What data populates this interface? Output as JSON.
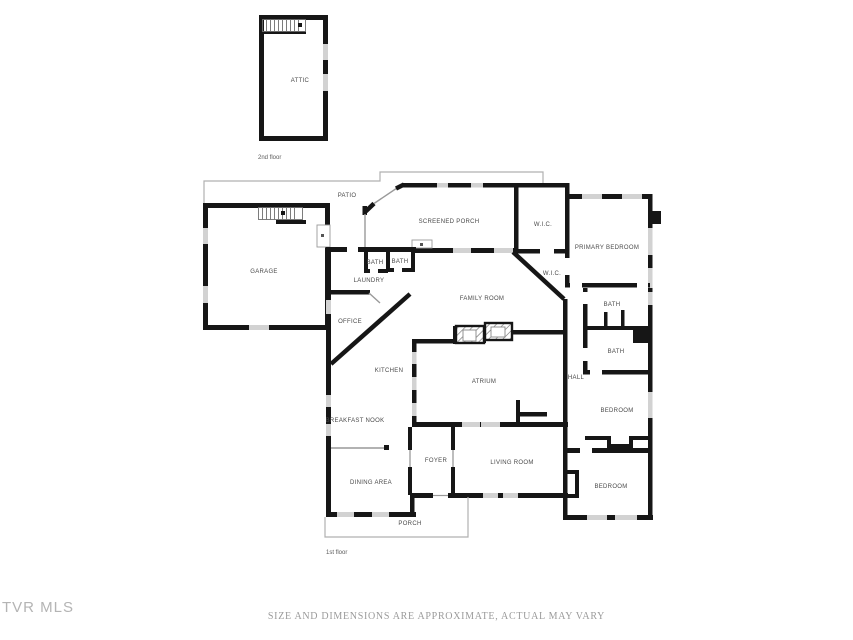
{
  "page": {
    "watermark": "TVR MLS",
    "footer_disclaimer": "SIZE AND DIMENSIONS ARE APPROXIMATE, ACTUAL MAY VARY"
  },
  "floorplan": {
    "floor2_label": "2nd floor",
    "floor1_label": "1st floor",
    "colors": {
      "wall": "#161616",
      "window": "#d2d2d2",
      "outline": "#b0b0b0",
      "label": "#4a4a4a"
    },
    "rooms": [
      {
        "label": "ATTIC",
        "x": 300,
        "y": 81
      },
      {
        "label": "PATIO",
        "x": 347,
        "y": 196
      },
      {
        "label": "SCREENED PORCH",
        "x": 449,
        "y": 222
      },
      {
        "label": "W.I.C.",
        "x": 543,
        "y": 225
      },
      {
        "label": "PRIMARY BEDROOM",
        "x": 607,
        "y": 248
      },
      {
        "label": "BATH",
        "x": 375,
        "y": 263
      },
      {
        "label": "BATH",
        "x": 400,
        "y": 262
      },
      {
        "label": "W.I.C.",
        "x": 552,
        "y": 274
      },
      {
        "label": "LAUNDRY",
        "x": 369,
        "y": 281
      },
      {
        "label": "GARAGE",
        "x": 264,
        "y": 272
      },
      {
        "label": "FAMILY ROOM",
        "x": 482,
        "y": 299
      },
      {
        "label": "BATH",
        "x": 612,
        "y": 305
      },
      {
        "label": "OFFICE",
        "x": 350,
        "y": 322
      },
      {
        "label": "BATH",
        "x": 616,
        "y": 352
      },
      {
        "label": "KITCHEN",
        "x": 389,
        "y": 371
      },
      {
        "label": "ATRIUM",
        "x": 484,
        "y": 382
      },
      {
        "label": "HALL",
        "x": 576,
        "y": 378
      },
      {
        "label": "BEDROOM",
        "x": 617,
        "y": 411
      },
      {
        "label": "BREAKFAST NOOK",
        "x": 355,
        "y": 421
      },
      {
        "label": "FOYER",
        "x": 436,
        "y": 461
      },
      {
        "label": "LIVING ROOM",
        "x": 512,
        "y": 463
      },
      {
        "label": "DINING AREA",
        "x": 371,
        "y": 483
      },
      {
        "label": "BEDROOM",
        "x": 611,
        "y": 487
      },
      {
        "label": "PORCH",
        "x": 410,
        "y": 524
      }
    ]
  }
}
